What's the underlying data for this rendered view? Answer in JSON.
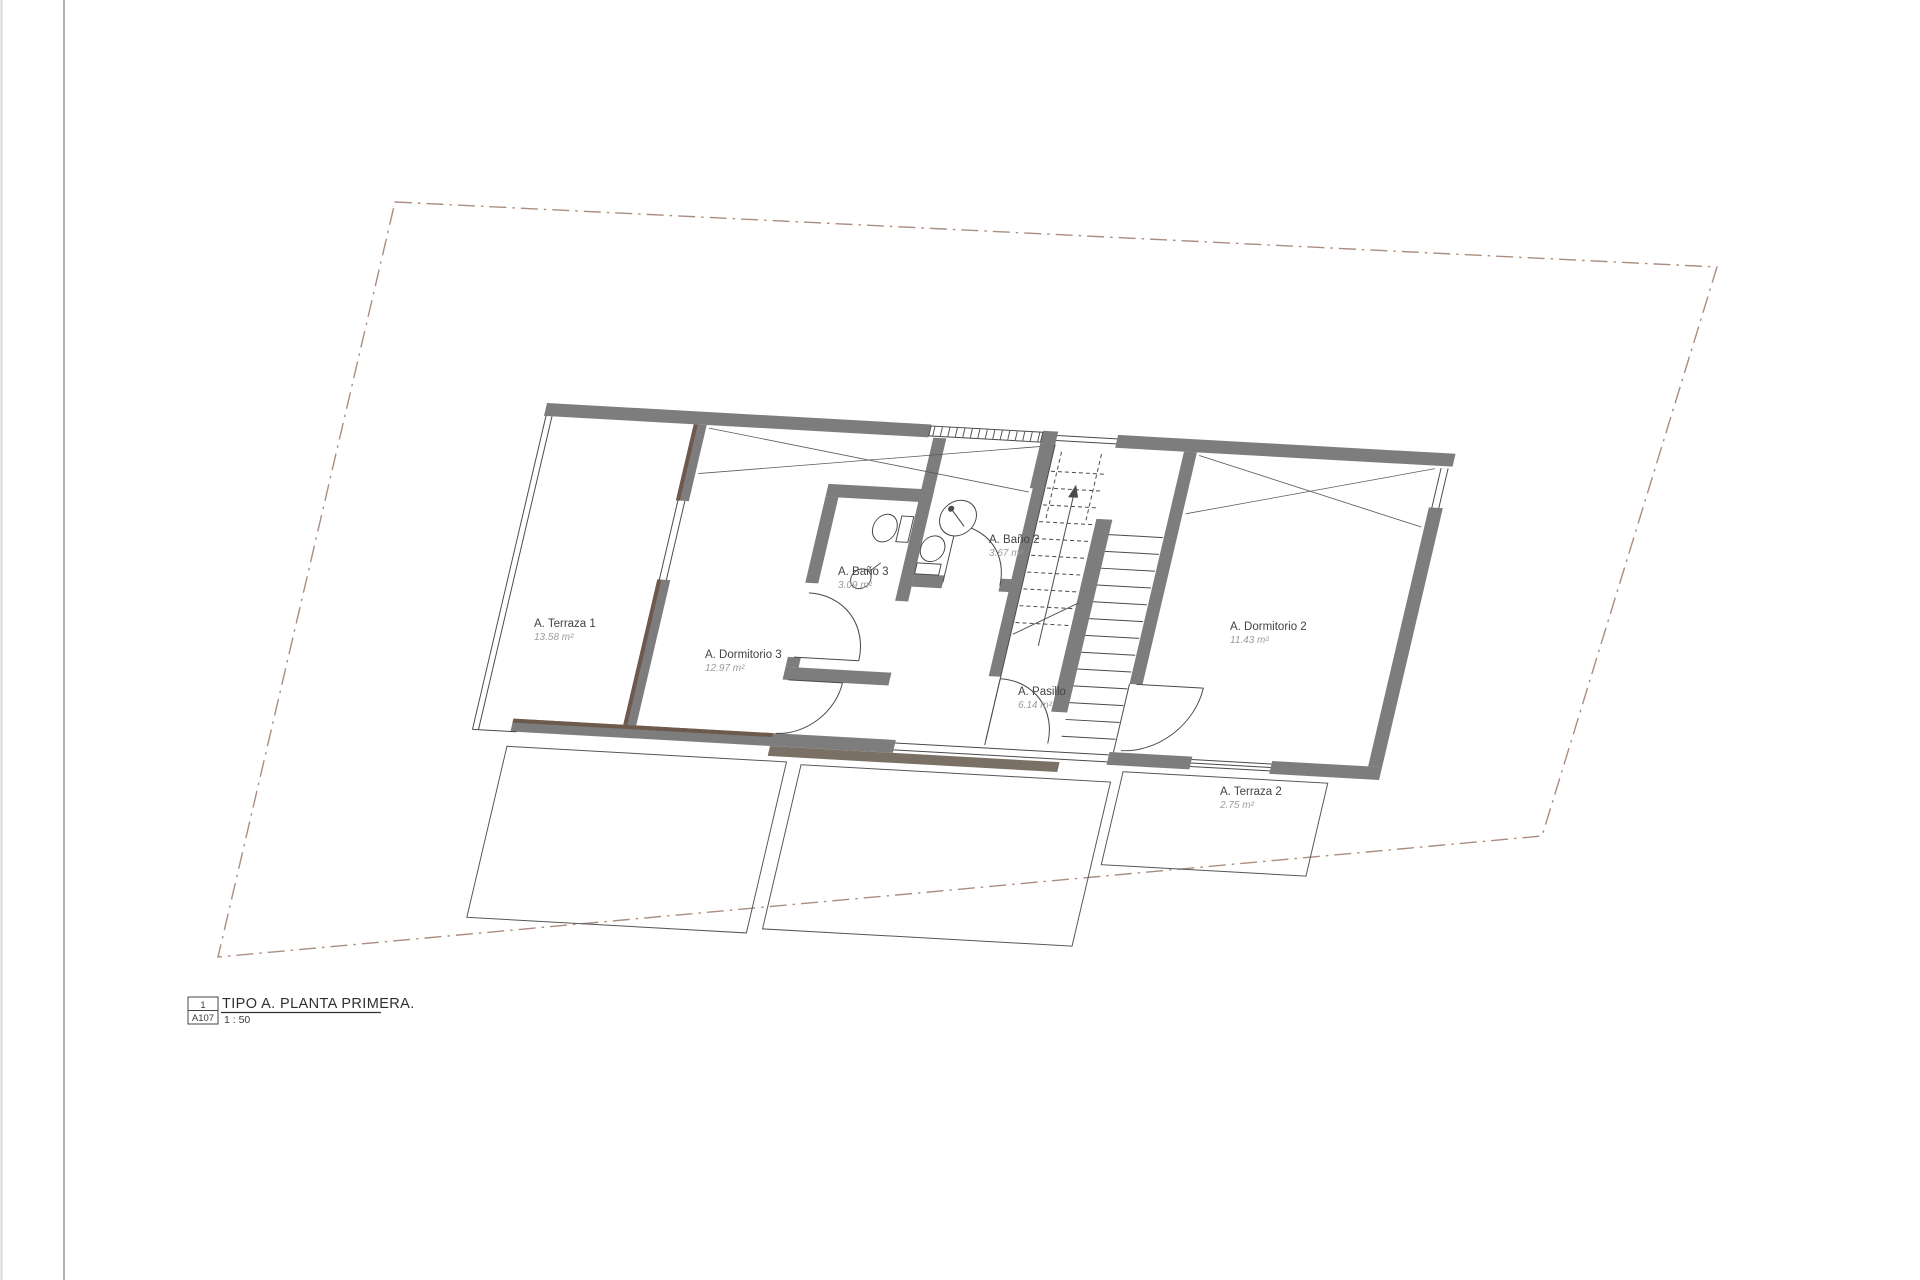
{
  "drawing": {
    "type": "architectural-floor-plan",
    "language": "es"
  },
  "rooms": [
    {
      "name": "A. Terraza 1",
      "area": "13.58 m²"
    },
    {
      "name": "A. Dormitorio 3",
      "area": "12.97 m²"
    },
    {
      "name": "A. Baño 3",
      "area": "3.09 m²"
    },
    {
      "name": "A. Baño 2",
      "area": "3.67 m²"
    },
    {
      "name": "A. Pasillo",
      "area": "6.14 m²"
    },
    {
      "name": "A. Dormitorio 2",
      "area": "11.43 m²"
    },
    {
      "name": "A. Terraza 2",
      "area": "2.75 m²"
    }
  ],
  "title_block": {
    "detail_number": "1",
    "sheet_number": "A107",
    "title": "TIPO A. PLANTA PRIMERA.",
    "scale": "1 : 50"
  },
  "colors": {
    "wall": "#7d7d7d",
    "wall_accent": "#6e5a4c",
    "boundary_dashdot": "#ab8d7f",
    "thin_line": "#4a4a4a",
    "sheet_margin": "#9a9a9a"
  }
}
